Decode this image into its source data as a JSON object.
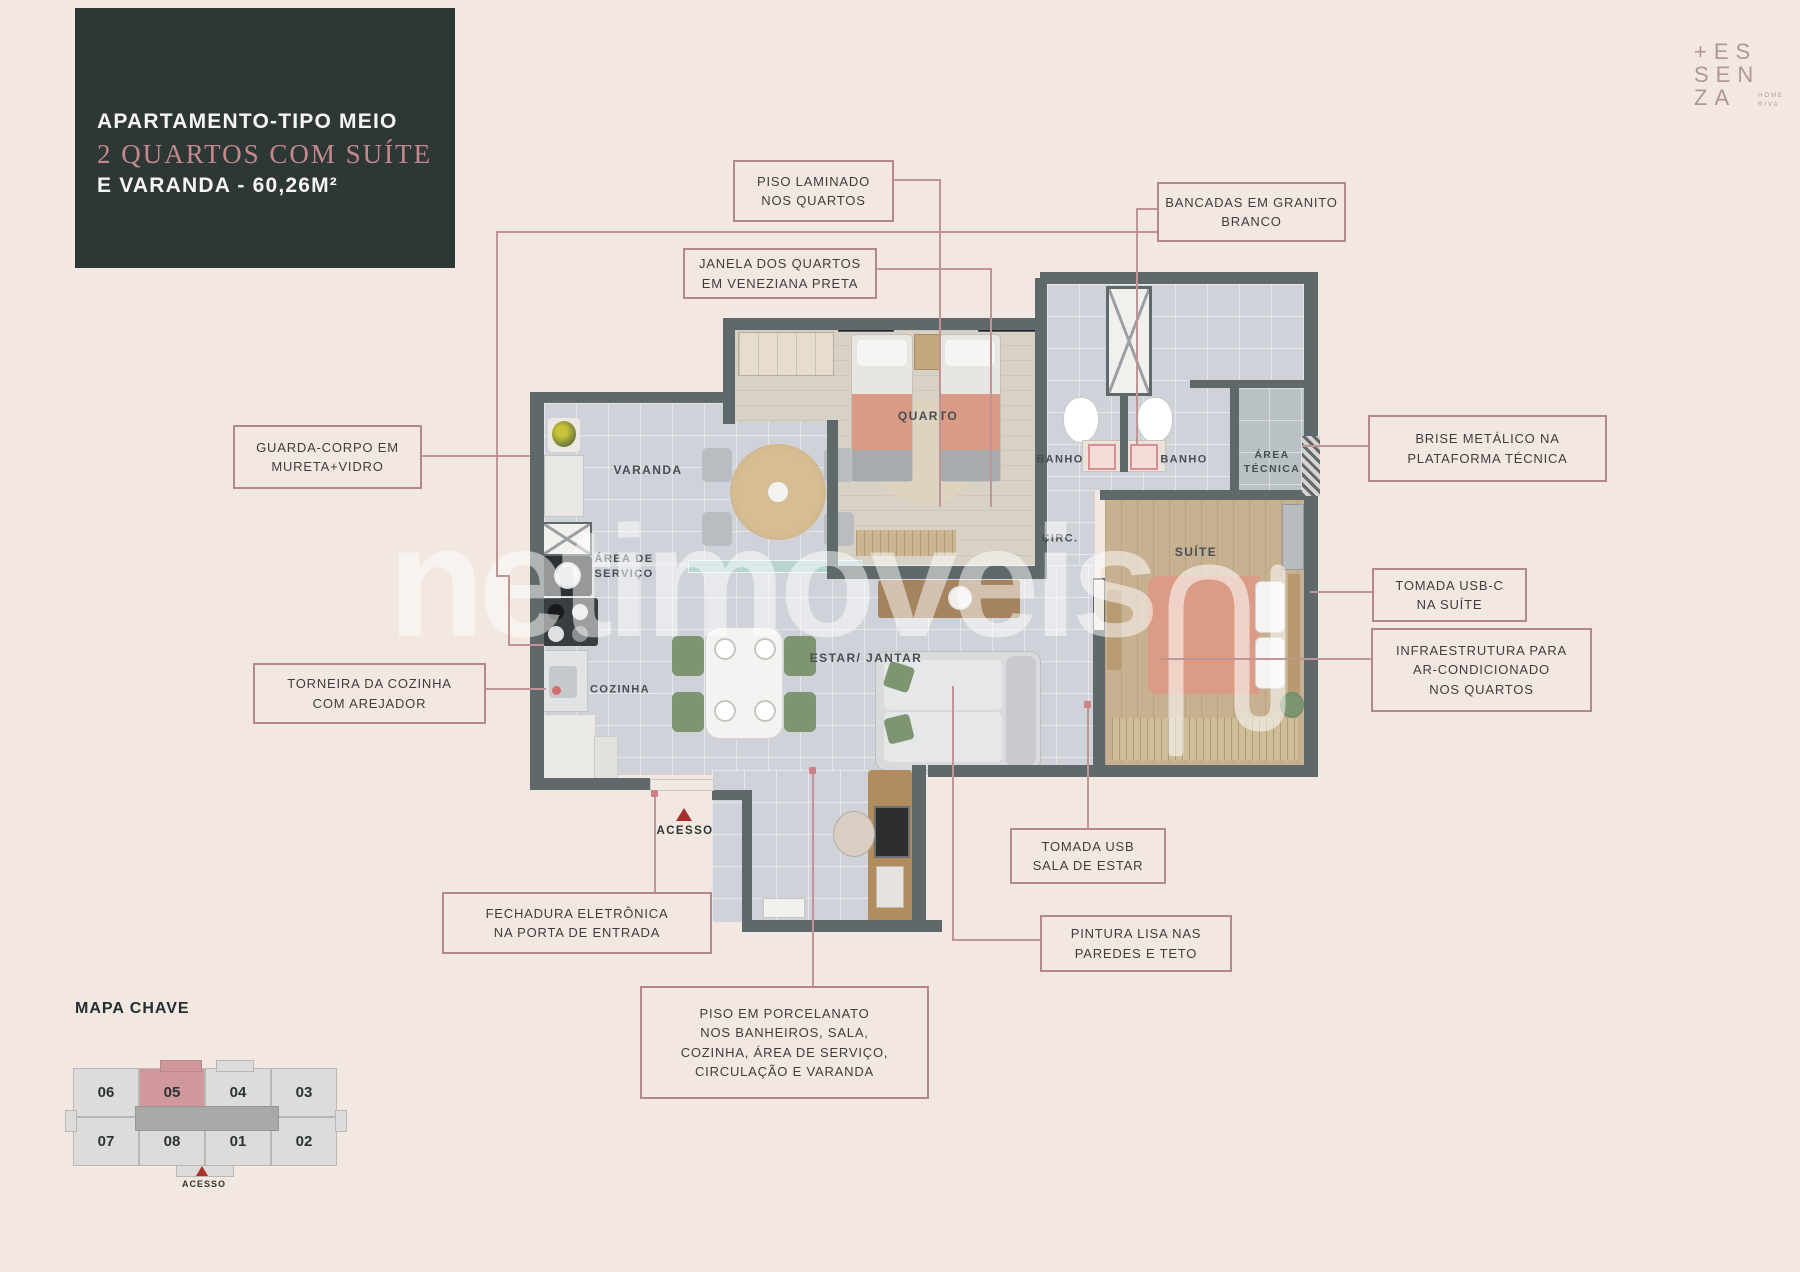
{
  "colors": {
    "background": "#f2e7e1",
    "panel_dark": "#2d3736",
    "accent_pink": "#c5888c",
    "callout_border": "#b3888b",
    "wall": "#5f686b",
    "wood": "#c8b190",
    "salmon_bed": "#dc9b85",
    "green_chair": "#7d9571",
    "acesso_red": "#a8302d",
    "map_highlight": "#d0989b"
  },
  "title_block": {
    "line1": "APARTAMENTO-TIPO MEIO",
    "line2": "2 QUARTOS COM SUÍTE",
    "line3": "E VARANDA - 60,26M²"
  },
  "logo": {
    "line1": "+ES",
    "line2": "SEN",
    "line3": "ZA",
    "tag1": "HOME",
    "tag2": "RIVA"
  },
  "watermark": "netimoveis",
  "callouts": [
    {
      "id": "piso-laminado",
      "text": "PISO LAMINADO\nNOS QUARTOS"
    },
    {
      "id": "bancadas",
      "text": "BANCADAS EM GRANITO\nBRANCO"
    },
    {
      "id": "janela",
      "text": "JANELA DOS QUARTOS\nEM VENEZIANA PRETA"
    },
    {
      "id": "guarda-corpo",
      "text": "GUARDA-CORPO EM\nMURETA+VIDRO"
    },
    {
      "id": "brise",
      "text": "BRISE METÁLICO NA\nPLATAFORMA TÉCNICA"
    },
    {
      "id": "tomada-usbc",
      "text": "TOMADA USB-C\nNA SUÍTE"
    },
    {
      "id": "infra-ar",
      "text": "INFRAESTRUTURA PARA\nAR-CONDICIONADO\nNOS QUARTOS"
    },
    {
      "id": "torneira",
      "text": "TORNEIRA DA COZINHA\nCOM AREJADOR"
    },
    {
      "id": "tomada-usb",
      "text": "TOMADA USB\nSALA DE ESTAR"
    },
    {
      "id": "pintura",
      "text": "PINTURA LISA NAS\nPAREDES E TETO"
    },
    {
      "id": "fechadura",
      "text": "FECHADURA ELETRÔNICA\nNA PORTA DE ENTRADA"
    },
    {
      "id": "porcelanato",
      "text": "PISO EM PORCELANATO\nNOS BANHEIROS, SALA,\nCOZINHA, ÁREA DE SERVIÇO,\nCIRCULAÇÃO E VARANDA"
    }
  ],
  "plan_labels": {
    "varanda": "VARANDA",
    "quarto": "QUARTO",
    "banho1": "BANHO",
    "banho2": "BANHO",
    "area_tecnica": "ÁREA\nTÉCNICA",
    "circ": "CIRC.",
    "suite": "SUÍTE",
    "estar_jantar": "ESTAR/ JANTAR",
    "area_servico": "ÁREA DE\nSERVIÇO",
    "cozinha": "COZINHA",
    "acesso": "ACESSO"
  },
  "mapa_chave": {
    "title": "MAPA CHAVE",
    "top_row": [
      "06",
      "05",
      "04",
      "03"
    ],
    "bottom_row": [
      "07",
      "08",
      "01",
      "02"
    ],
    "highlighted_unit": "05",
    "acesso": "ACESSO"
  }
}
